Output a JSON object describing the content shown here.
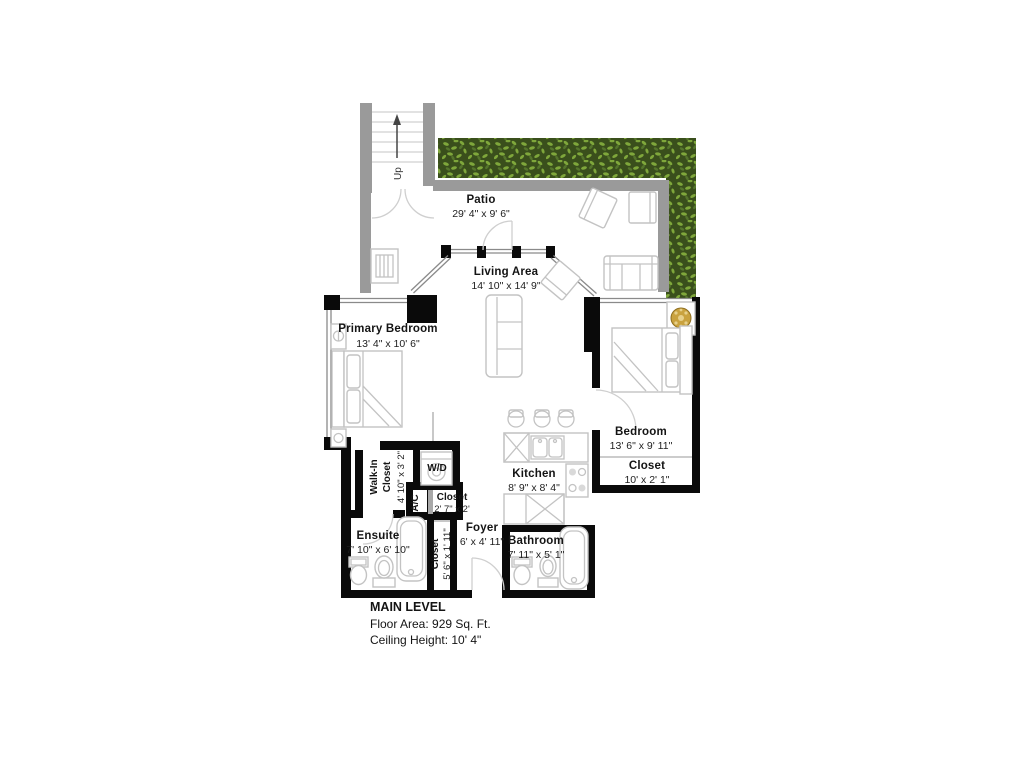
{
  "stairs": {
    "label": "Up"
  },
  "rooms": {
    "patio": {
      "name": "Patio",
      "dims": "29' 4\" x 9' 6\""
    },
    "living": {
      "name": "Living Area",
      "dims": "14' 10\" x 14' 9\""
    },
    "primary_bedroom": {
      "name": "Primary Bedroom",
      "dims": "13' 4\" x 10' 6\""
    },
    "bedroom": {
      "name": "Bedroom",
      "dims": "13' 6\" x 9' 11\""
    },
    "bedroom_closet": {
      "name": "Closet",
      "dims": "10' x 2' 1\""
    },
    "kitchen": {
      "name": "Kitchen",
      "dims": "8' 9\" x 8' 4\""
    },
    "walk_in_closet": {
      "name_line1": "Walk-In",
      "name_line2": "Closet",
      "dims": "4' 10\" x 3' 2\""
    },
    "wd": {
      "name": "W/D"
    },
    "ac": {
      "name": "A/C"
    },
    "hall_closet": {
      "name": "Closet",
      "dims": "2' 7\" x 2'"
    },
    "ensuite": {
      "name": "Ensuite",
      "dims": "7' 10\" x 6' 10\""
    },
    "foyer_closet": {
      "name": "Closet",
      "dims": "5' 6\" x 1' 11\""
    },
    "foyer": {
      "name": "Foyer",
      "dims": "6' x 4' 11\""
    },
    "bathroom": {
      "name": "Bathroom",
      "dims": "7' 11\" x 5' 1\""
    }
  },
  "footer": {
    "title": "MAIN LEVEL",
    "floor_area": "Floor Area: 929 Sq. Ft.",
    "ceiling_height": "Ceiling Height: 10' 4\""
  },
  "colors": {
    "wall_black": "#0a0a0a",
    "patio_wall_gray": "#9a9a9a",
    "hedge_dark_green": "#3a4f1c",
    "hedge_light_green": "#7fa73b",
    "plant_gold": "#c9a23f",
    "text": "#141414"
  }
}
